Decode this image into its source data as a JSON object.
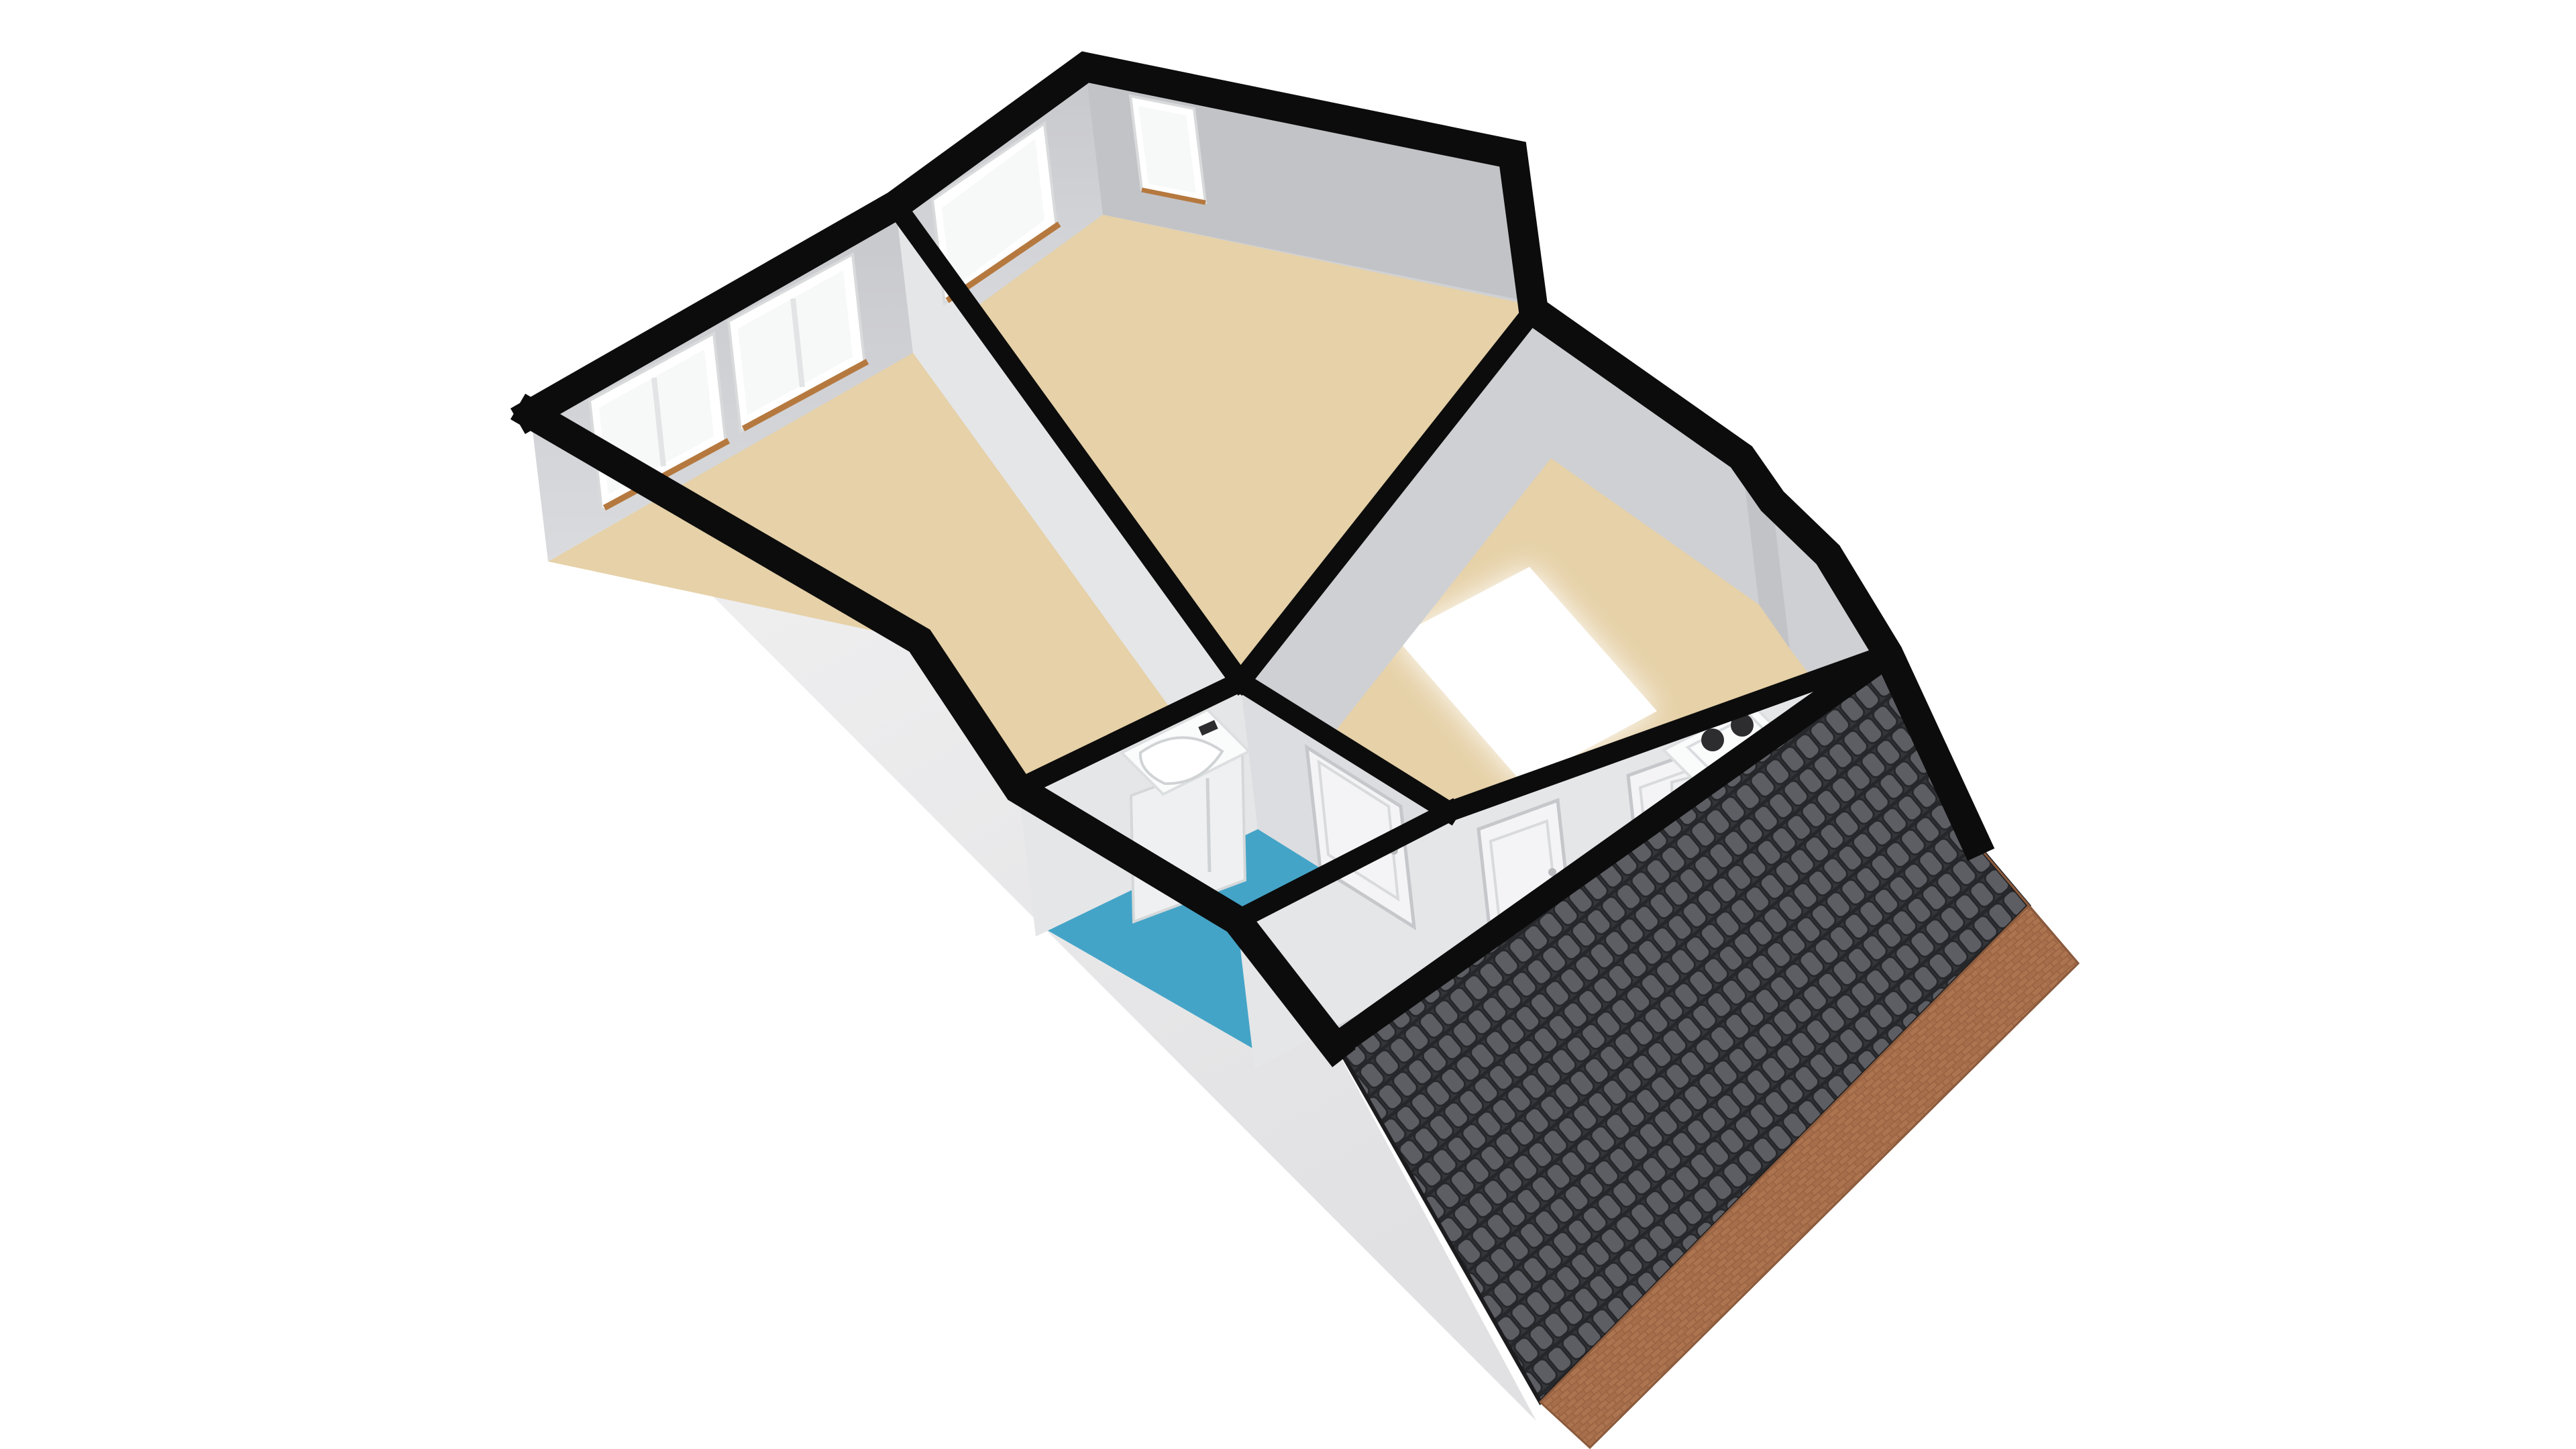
{
  "viewer": {
    "type": "3d-floorplan-axonometric-render",
    "background": "#ffffff",
    "floor_shown": "attic-storey"
  },
  "palette": {
    "background": "#ffffff",
    "wall_cut": "#0c0c0c",
    "wall_face_light": "#dcdde0",
    "wall_face_mid": "#cfd0d4",
    "wall_face_dark": "#c2c3c7",
    "wall_face_bright": "#e5e6e8",
    "interior_base": "#d0d1d4",
    "facade_top": "#f2f2f3",
    "facade_bottom": "#e1e1e3",
    "floor_wood": "#e6d1a8",
    "floor_bath": "#44a4c7",
    "floor_utility": "#dfe3e6",
    "stair_void": "#ffffff",
    "roof_tile_base": "#35363a",
    "roof_tile": "#5d5e64",
    "roof_tile_gap": "#26272a",
    "roof_edge": "#1c1c1e",
    "brick": "#9b6544",
    "brick_light": "#ad7450",
    "brick_mid": "#a76e4c",
    "brick_dark": "#8a5a3c",
    "window_glass": "#f7f8f8",
    "window_frame": "#ffffff",
    "window_frame_edge": "#d9dadb",
    "window_sill": "#b5793f",
    "door": "#f4f4f6",
    "door_outline": "#c6c7cb",
    "appliance": "#fafbfb",
    "appliance_front": "#eff0f2",
    "appliance_edge": "#d5d8d9",
    "knob": "#2d2d30"
  },
  "scene": {
    "rooms": [
      {
        "name": "room-left",
        "floor_color_key": "floor_wood",
        "windows": 2
      },
      {
        "name": "room-top",
        "floor_color_key": "floor_wood",
        "windows": 2
      },
      {
        "name": "landing-hall",
        "floor_color_key": "floor_wood",
        "features": [
          "stair-void"
        ]
      },
      {
        "name": "bathroom",
        "floor_color_key": "floor_bath",
        "fixtures": [
          "sink-vanity-unit"
        ]
      },
      {
        "name": "attic-room",
        "floor_color_key": "floor_utility",
        "fixtures": [
          "washing-machine"
        ],
        "doors": 3
      }
    ],
    "exterior": {
      "roof": "dark-grey-pantile-slope",
      "gable": "red-brick",
      "facade": "light-grey-render"
    },
    "windows_total": 4,
    "doors_total": 3,
    "furniture_total": 2
  }
}
